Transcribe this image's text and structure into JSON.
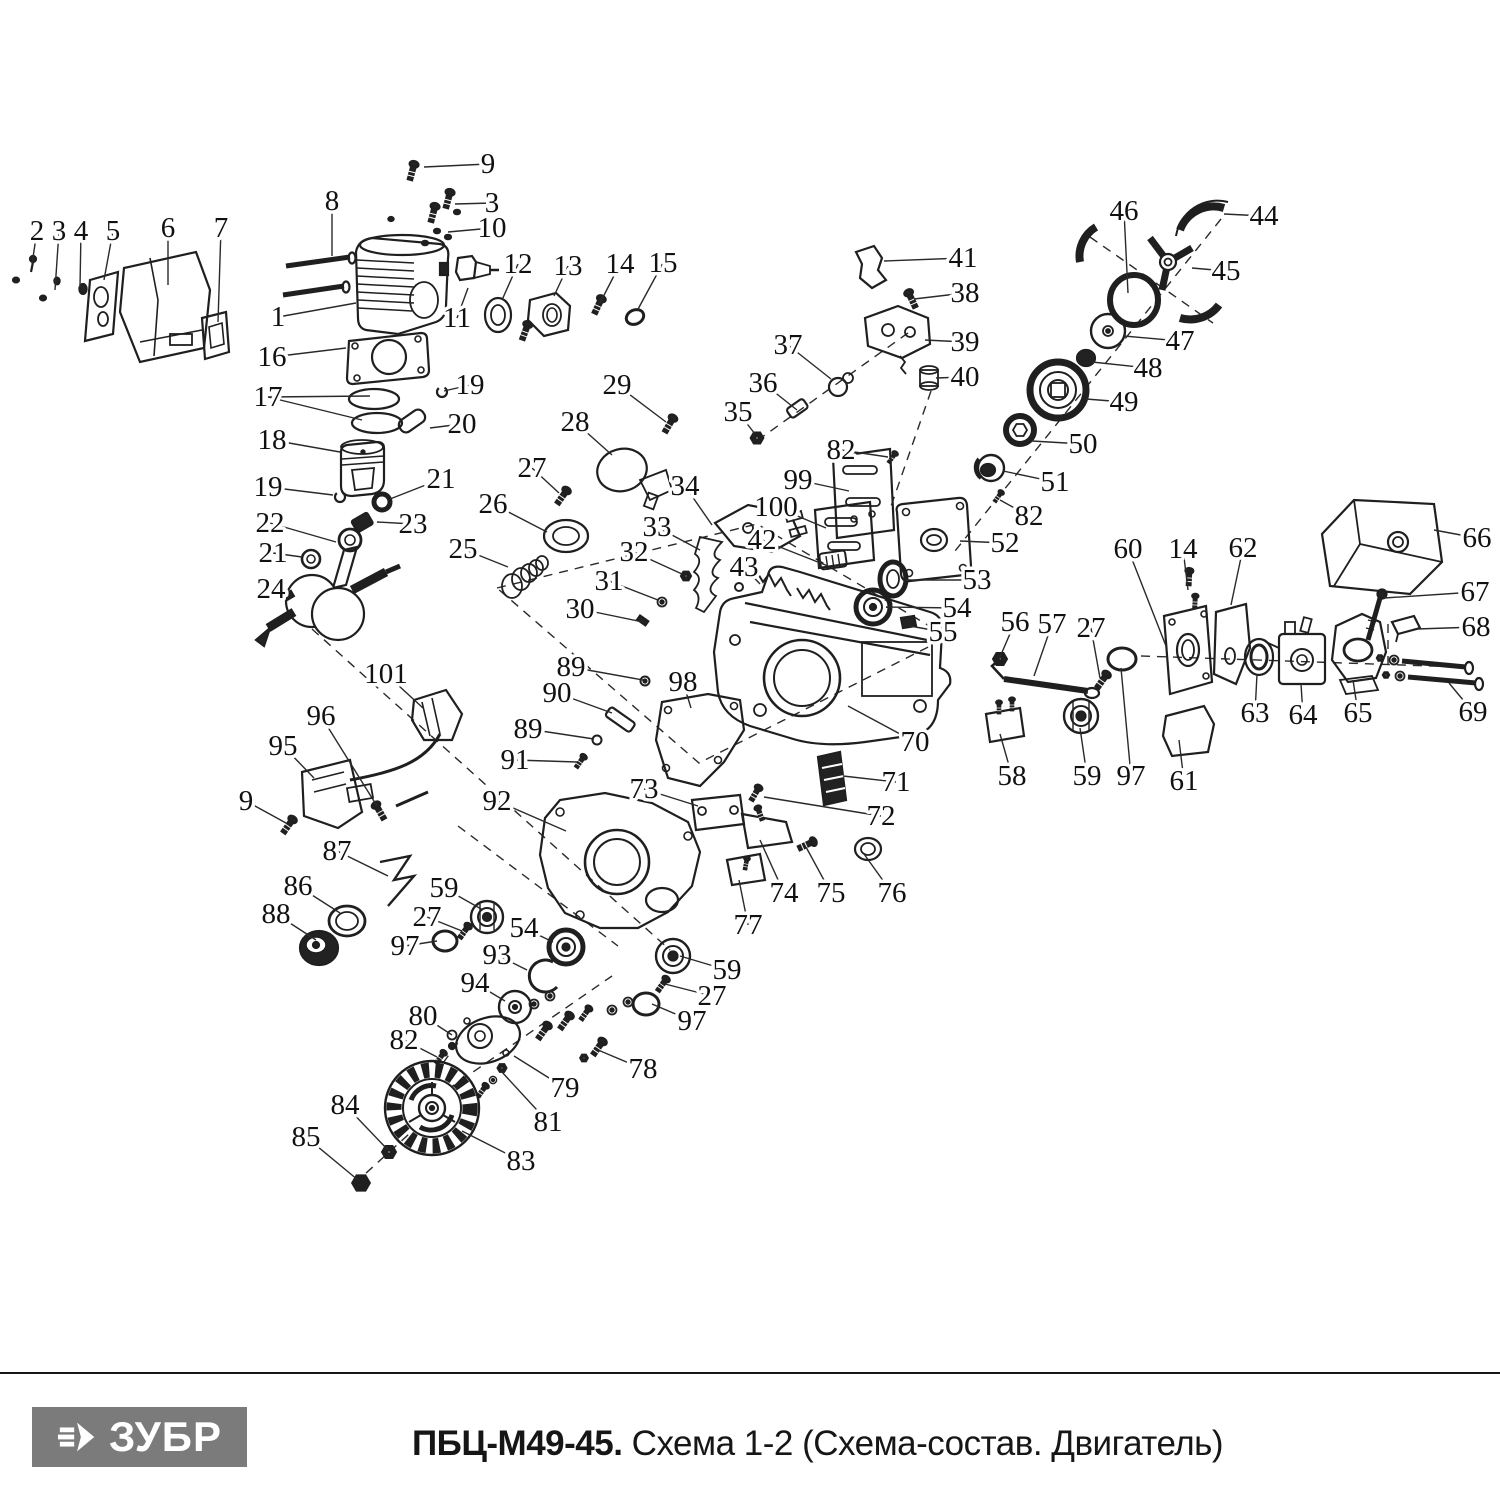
{
  "footer": {
    "brand": "ЗУБР",
    "model": "ПБЦ-М49-45.",
    "subtitle": " Схема 1-2 (Схема-состав. Двигатель)",
    "logo_bg": "#7b7b7b",
    "divider_color": "#161616"
  },
  "diagram": {
    "ink": "#1f1f1f",
    "description": "Exploded parts schematic of chainsaw engine with numbered callouts",
    "callouts": [
      [
        "2",
        37,
        231,
        32,
        264
      ],
      [
        "3",
        59,
        231,
        55,
        290
      ],
      [
        "4",
        81,
        231,
        80,
        287
      ],
      [
        "5",
        113,
        231,
        104,
        280
      ],
      [
        "6",
        168,
        228,
        168,
        285
      ],
      [
        "7",
        221,
        228,
        218,
        322
      ],
      [
        "8",
        332,
        201,
        332,
        256
      ],
      [
        "9",
        488,
        164,
        424,
        167
      ],
      [
        "3",
        492,
        203,
        455,
        204
      ],
      [
        "10",
        492,
        228,
        448,
        232
      ],
      [
        "1",
        278,
        317,
        356,
        303
      ],
      [
        "11",
        457,
        318,
        468,
        288
      ],
      [
        "12",
        518,
        264,
        502,
        300
      ],
      [
        "13",
        568,
        266,
        554,
        296
      ],
      [
        "14",
        620,
        264,
        600,
        303
      ],
      [
        "15",
        663,
        263,
        637,
        311
      ],
      [
        "16",
        272,
        357,
        346,
        348
      ],
      [
        "17",
        268,
        397,
        370,
        396,
        362,
        420
      ],
      [
        "19",
        470,
        385,
        444,
        391
      ],
      [
        "20",
        462,
        424,
        430,
        428
      ],
      [
        "18",
        272,
        440,
        340,
        452
      ],
      [
        "19",
        268,
        487,
        333,
        495
      ],
      [
        "21",
        441,
        479,
        390,
        499
      ],
      [
        "22",
        270,
        523,
        336,
        542
      ],
      [
        "23",
        413,
        524,
        377,
        522
      ],
      [
        "21",
        273,
        553,
        302,
        557
      ],
      [
        "24",
        271,
        589,
        289,
        597
      ],
      [
        "26",
        493,
        504,
        547,
        532
      ],
      [
        "25",
        463,
        549,
        508,
        567
      ],
      [
        "27",
        532,
        468,
        559,
        493
      ],
      [
        "28",
        575,
        422,
        612,
        455
      ],
      [
        "29",
        617,
        385,
        666,
        422
      ],
      [
        "34",
        685,
        486,
        712,
        525
      ],
      [
        "33",
        657,
        527,
        700,
        550
      ],
      [
        "32",
        634,
        552,
        682,
        574
      ],
      [
        "31",
        609,
        581,
        658,
        600
      ],
      [
        "30",
        580,
        609,
        643,
        622
      ],
      [
        "35",
        738,
        412,
        755,
        434
      ],
      [
        "36",
        763,
        383,
        797,
        410
      ],
      [
        "37",
        788,
        345,
        831,
        379
      ],
      [
        "41",
        963,
        258,
        884,
        261
      ],
      [
        "38",
        965,
        293,
        914,
        299
      ],
      [
        "39",
        965,
        342,
        925,
        340
      ],
      [
        "40",
        965,
        377,
        936,
        378
      ],
      [
        "82",
        841,
        450,
        888,
        457
      ],
      [
        "99",
        798,
        480,
        849,
        491
      ],
      [
        "100",
        776,
        507,
        826,
        528
      ],
      [
        "42",
        762,
        540,
        828,
        566
      ],
      [
        "43",
        744,
        567,
        760,
        584
      ],
      [
        "53",
        977,
        580,
        905,
        580
      ],
      [
        "54",
        957,
        608,
        886,
        607
      ],
      [
        "55",
        943,
        632,
        910,
        626
      ],
      [
        "52",
        1005,
        543,
        960,
        541
      ],
      [
        "82",
        1029,
        516,
        1000,
        500
      ],
      [
        "50",
        1083,
        444,
        1032,
        441
      ],
      [
        "51",
        1055,
        482,
        1003,
        471
      ],
      [
        "49",
        1124,
        402,
        1086,
        399
      ],
      [
        "48",
        1148,
        368,
        1092,
        362
      ],
      [
        "47",
        1180,
        341,
        1124,
        336
      ],
      [
        "46",
        1124,
        211,
        1128,
        293
      ],
      [
        "44",
        1264,
        216,
        1224,
        214
      ],
      [
        "45",
        1226,
        271,
        1192,
        268
      ],
      [
        "66",
        1477,
        538,
        1434,
        530
      ],
      [
        "67",
        1475,
        592,
        1384,
        598
      ],
      [
        "68",
        1476,
        627,
        1417,
        629
      ],
      [
        "69",
        1473,
        712,
        1449,
        683
      ],
      [
        "60",
        1128,
        549,
        1166,
        646
      ],
      [
        "14",
        1183,
        549,
        1188,
        590
      ],
      [
        "62",
        1243,
        548,
        1231,
        605
      ],
      [
        "63",
        1255,
        713,
        1257,
        674
      ],
      [
        "64",
        1303,
        715,
        1301,
        684
      ],
      [
        "65",
        1358,
        713,
        1353,
        680
      ],
      [
        "27",
        1091,
        628,
        1100,
        678
      ],
      [
        "56",
        1015,
        622,
        1000,
        657
      ],
      [
        "57",
        1052,
        624,
        1034,
        676
      ],
      [
        "58",
        1012,
        776,
        1000,
        734
      ],
      [
        "59",
        1087,
        776,
        1080,
        728
      ],
      [
        "97",
        1131,
        776,
        1121,
        668
      ],
      [
        "61",
        1184,
        781,
        1179,
        740
      ],
      [
        "101",
        386,
        674,
        423,
        708
      ],
      [
        "96",
        321,
        716,
        377,
        806
      ],
      [
        "95",
        283,
        746,
        314,
        778
      ],
      [
        "9",
        246,
        801,
        286,
        823
      ],
      [
        "87",
        337,
        851,
        388,
        876
      ],
      [
        "86",
        298,
        886,
        340,
        913
      ],
      [
        "88",
        276,
        914,
        316,
        940
      ],
      [
        "92",
        497,
        801,
        566,
        831
      ],
      [
        "89",
        571,
        667,
        643,
        680
      ],
      [
        "90",
        557,
        693,
        612,
        713
      ],
      [
        "89",
        528,
        729,
        594,
        739
      ],
      [
        "91",
        515,
        760,
        577,
        762
      ],
      [
        "73",
        644,
        789,
        698,
        806
      ],
      [
        "98",
        683,
        682,
        691,
        708
      ],
      [
        "70",
        915,
        742,
        848,
        706
      ],
      [
        "71",
        896,
        782,
        843,
        776
      ],
      [
        "72",
        881,
        816,
        764,
        797
      ],
      [
        "74",
        784,
        893,
        760,
        840
      ],
      [
        "75",
        831,
        893,
        806,
        847
      ],
      [
        "76",
        892,
        893,
        864,
        854
      ],
      [
        "77",
        748,
        925,
        739,
        880
      ],
      [
        "59",
        444,
        888,
        483,
        910
      ],
      [
        "27",
        427,
        917,
        462,
        931
      ],
      [
        "97",
        405,
        946,
        437,
        941
      ],
      [
        "54",
        524,
        928,
        553,
        942
      ],
      [
        "93",
        497,
        955,
        527,
        970
      ],
      [
        "94",
        475,
        983,
        505,
        1001
      ],
      [
        "59",
        727,
        970,
        680,
        956
      ],
      [
        "27",
        712,
        996,
        665,
        984
      ],
      [
        "97",
        692,
        1021,
        652,
        1004
      ],
      [
        "80",
        423,
        1016,
        452,
        1035
      ],
      [
        "82",
        404,
        1040,
        437,
        1057
      ],
      [
        "79",
        565,
        1088,
        514,
        1056
      ],
      [
        "81",
        548,
        1122,
        501,
        1071
      ],
      [
        "78",
        643,
        1069,
        598,
        1050
      ],
      [
        "84",
        345,
        1105,
        388,
        1150
      ],
      [
        "85",
        306,
        1137,
        358,
        1180
      ],
      [
        "83",
        521,
        1161,
        462,
        1131
      ]
    ]
  }
}
